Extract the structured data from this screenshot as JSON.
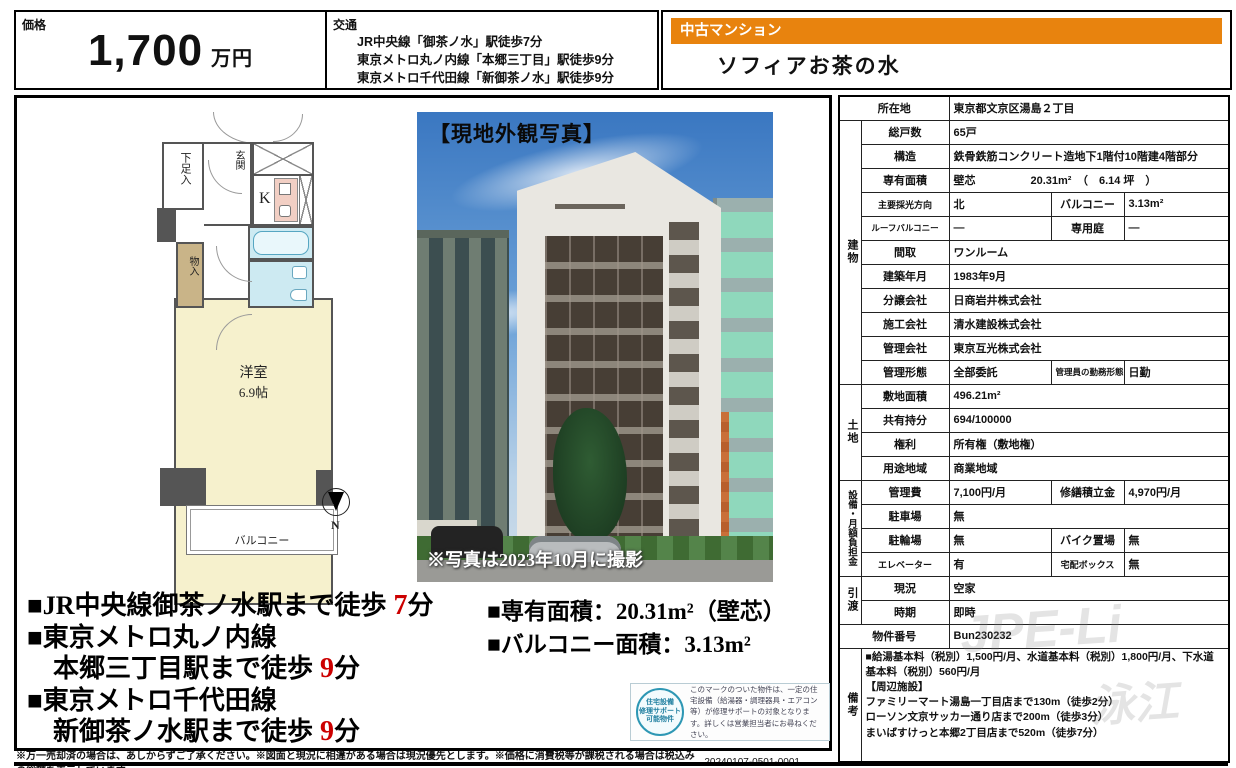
{
  "colors": {
    "accent_orange": "#e8830e",
    "highlight_red": "#cc0000",
    "plan_room_yellow": "#f6f1cd",
    "plan_bath_blue": "#cdeaf2",
    "plan_kitchen_pink": "#f2cfc4",
    "plan_storage_tan": "#c9b488",
    "seal_teal": "#2e97b4"
  },
  "header": {
    "price_label": "価格",
    "price_value": "1,700",
    "price_unit": "万円",
    "transit_label": "交通",
    "transit_lines": [
      "JR中央線「御茶ノ水」駅徒歩7分",
      "東京メトロ丸ノ内線「本郷三丁目」駅徒歩9分",
      "東京メトロ千代田線「新御茶ノ水」駅徒歩9分"
    ],
    "property_type": "中古マンション",
    "property_name": "ソフィアお茶の水"
  },
  "floorplan": {
    "shoe_closet": "下足入",
    "entrance": "玄関",
    "kitchen": "K",
    "storage": "物入",
    "room": "洋室",
    "room_size": "6.9帖",
    "balcony": "バルコニー",
    "compass_n": "N"
  },
  "photo": {
    "caption_top": "【現地外観写真】",
    "caption_bottom": "※写真は2023年10月に撮影"
  },
  "highlights": {
    "transit_lines": [
      {
        "text": "■JR中央線御茶ノ水駅まで徒歩",
        "num": "7",
        "tail": "分"
      },
      {
        "text": "■東京メトロ丸ノ内線",
        "num": "",
        "tail": ""
      },
      {
        "text": "　本郷三丁目駅まで徒歩",
        "num": "9",
        "tail": "分"
      },
      {
        "text": "■東京メトロ千代田線",
        "num": "",
        "tail": ""
      },
      {
        "text": "　新御茶ノ水駅まで徒歩",
        "num": "9",
        "tail": "分"
      }
    ],
    "area_lines": [
      "■専有面積：20.31m²（壁芯）",
      "■バルコニー面積：3.13m²"
    ]
  },
  "badge": {
    "seal_lines": [
      "住宅設備",
      "修理サポート",
      "可能物件"
    ],
    "description": "このマークのついた物件は、一定の住宅設備（給湯器・調理器具・エアコン等）が修理サポートの対象となります。詳しくは営業担当者にお尋ねください。"
  },
  "footer": {
    "disclaimer": "※万一売却済の場合は、あしからずご了承ください。※図面と現況に相違がある場合は現況優先とします。※価格に消費税等が課税される場合は税込みの総額を表示しています。",
    "doc_number": "20240107-0501-0001"
  },
  "watermark": {
    "text1": "JPE-Li",
    "text2": "泳江"
  },
  "table": {
    "rows": [
      {
        "wide": true,
        "label": "所在地",
        "value": "東京都文京区湯島２丁目"
      },
      {
        "group": {
          "text": "建物",
          "span": 11
        },
        "label": "総戸数",
        "value": "65戸"
      },
      {
        "label": "構造",
        "value": "鉄骨鉄筋コンクリート造地下1階付10階建4階部分"
      },
      {
        "label": "専有面積",
        "value": "壁芯　　　　　20.31m²　（　6.14 坪　）"
      },
      {
        "label": "主要採光方向",
        "value": "北",
        "label2": "バルコニー",
        "value2": "3.13m²"
      },
      {
        "label": "ルーフバルコニー",
        "value": "―",
        "label2": "専用庭",
        "value2": "―"
      },
      {
        "label": "間取",
        "value": "ワンルーム"
      },
      {
        "label": "建築年月",
        "value": "1983年9月"
      },
      {
        "label": "分譲会社",
        "value": "日商岩井株式会社"
      },
      {
        "label": "施工会社",
        "value": "清水建設株式会社"
      },
      {
        "label": "管理会社",
        "value": "東京互光株式会社"
      },
      {
        "label": "管理形態",
        "value": "全部委託",
        "label2": "管理員の勤務形態",
        "value2": "日勤"
      },
      {
        "group": {
          "text": "土地",
          "span": 4
        },
        "label": "敷地面積",
        "value": "496.21m²"
      },
      {
        "label": "共有持分",
        "value": "694/100000"
      },
      {
        "label": "権利",
        "value": "所有権（敷地権）"
      },
      {
        "label": "用途地域",
        "value": "商業地域"
      },
      {
        "group": {
          "text": "設備・月額負担金",
          "span": 4
        },
        "label": "管理費",
        "value": "7,100円/月",
        "label2": "修繕積立金",
        "value2": "4,970円/月"
      },
      {
        "label": "駐車場",
        "value": "無"
      },
      {
        "label": "駐輪場",
        "value": "無",
        "label2": "バイク置場",
        "value2": "無"
      },
      {
        "label": "エレベーター",
        "value": "有",
        "label2": "宅配ボックス",
        "value2": "無"
      },
      {
        "group": {
          "text": "引渡",
          "span": 2
        },
        "label": "現況",
        "value": "空家"
      },
      {
        "label": "時期",
        "value": "即時"
      },
      {
        "wide": true,
        "label": "物件番号",
        "value": "Bun230232"
      },
      {
        "group": {
          "text": "備考",
          "span": 1
        },
        "remarks": [
          "■給湯基本料（税別）1,500円/月、水道基本料（税別）1,800円/月、下水道基本料（税別）560円/月",
          "【周辺施設】",
          "ファミリーマート湯島一丁目店まで130m（徒歩2分）",
          "ローソン文京サッカー通り店まで200m（徒歩3分）",
          "まいばすけっと本郷2丁目店まで520m（徒歩7分）"
        ]
      }
    ]
  }
}
